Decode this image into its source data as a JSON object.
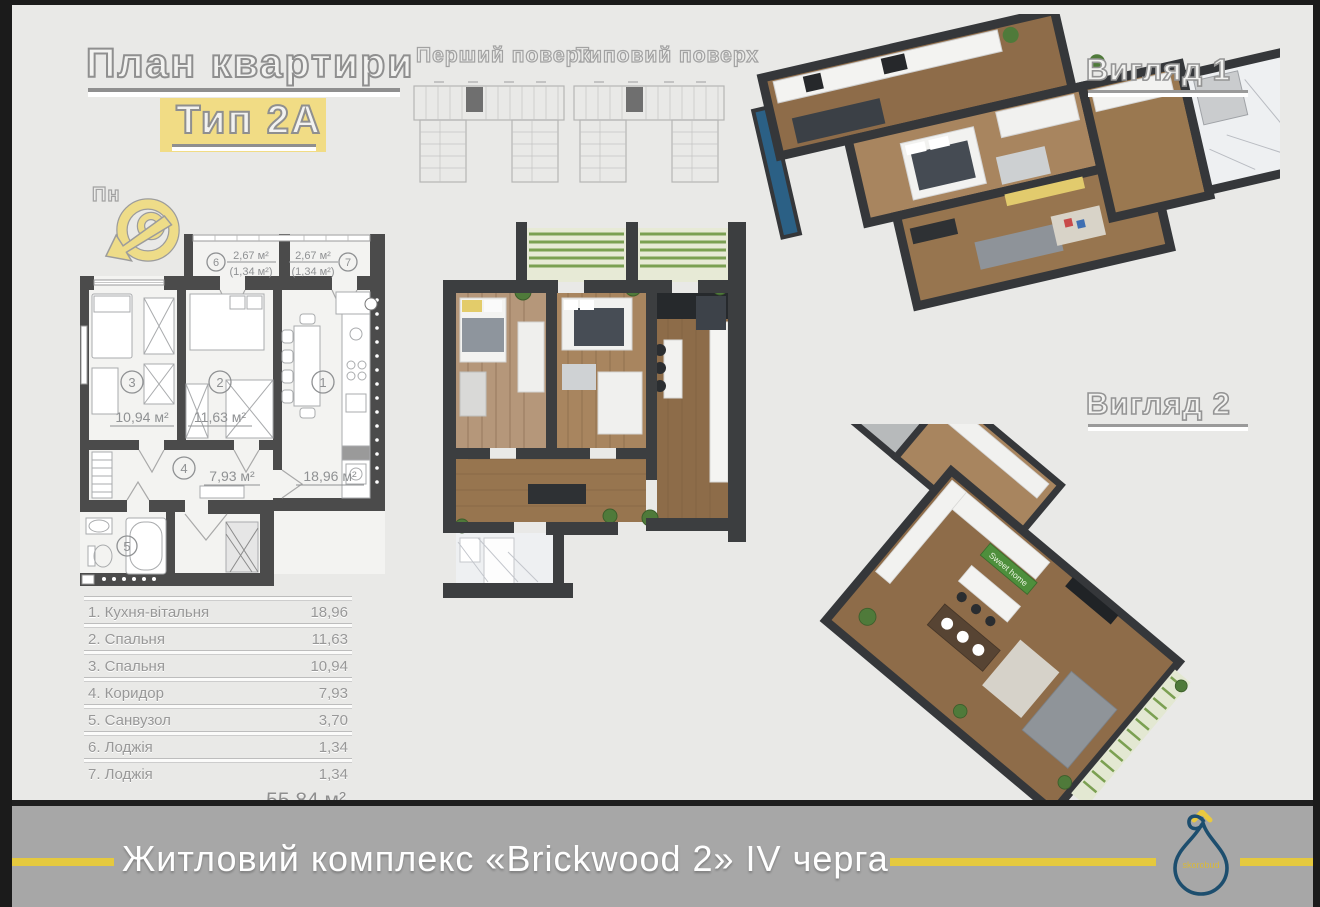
{
  "header": {
    "title": "План квартири",
    "type": "Тип 2А",
    "compass": "Пн"
  },
  "floor_overviews": {
    "first": "Перший поверх",
    "typical": "Типовий поверх"
  },
  "views": {
    "v1": "Вигляд 1",
    "v2": "Вигляд 2",
    "v2_sign": "Sweet home"
  },
  "plan": {
    "room1_num": "1",
    "room1_area": "18,96 м²",
    "room2_num": "2",
    "room2_area": "11,63 м²",
    "room3_num": "3",
    "room3_area": "10,94 м²",
    "room4_num": "4",
    "room4_area": "7,93 м²",
    "room5_num": "5",
    "loggia6_num": "6",
    "loggia6_area": "2,67 м²",
    "loggia6_reduced": "(1,34 м²)",
    "loggia7_num": "7",
    "loggia7_area": "2,67 м²",
    "loggia7_reduced": "(1,34 м²)"
  },
  "table": {
    "rows": [
      {
        "label": "1. Кухня-вітальня",
        "value": "18,96"
      },
      {
        "label": "2. Спальня",
        "value": "11,63"
      },
      {
        "label": "3. Спальня",
        "value": "10,94"
      },
      {
        "label": "4. Коридор",
        "value": "7,93"
      },
      {
        "label": "5. Санвузол",
        "value": "3,70"
      },
      {
        "label": "6. Лоджія",
        "value": "1,34"
      },
      {
        "label": "7. Лоджія",
        "value": "1,34"
      }
    ],
    "total": "55,84 м²"
  },
  "footer": {
    "title": "Житловий комплекс «Brickwood 2» IV черга",
    "logo_text": "skorobud"
  },
  "colors": {
    "accent_yellow": "#e5c93e",
    "highlight_yellow": "#f1dc85",
    "logo_navy": "#1d4e6e",
    "wall_dark": "#4b4b4b",
    "banner_gray": "#a7a7a7"
  }
}
